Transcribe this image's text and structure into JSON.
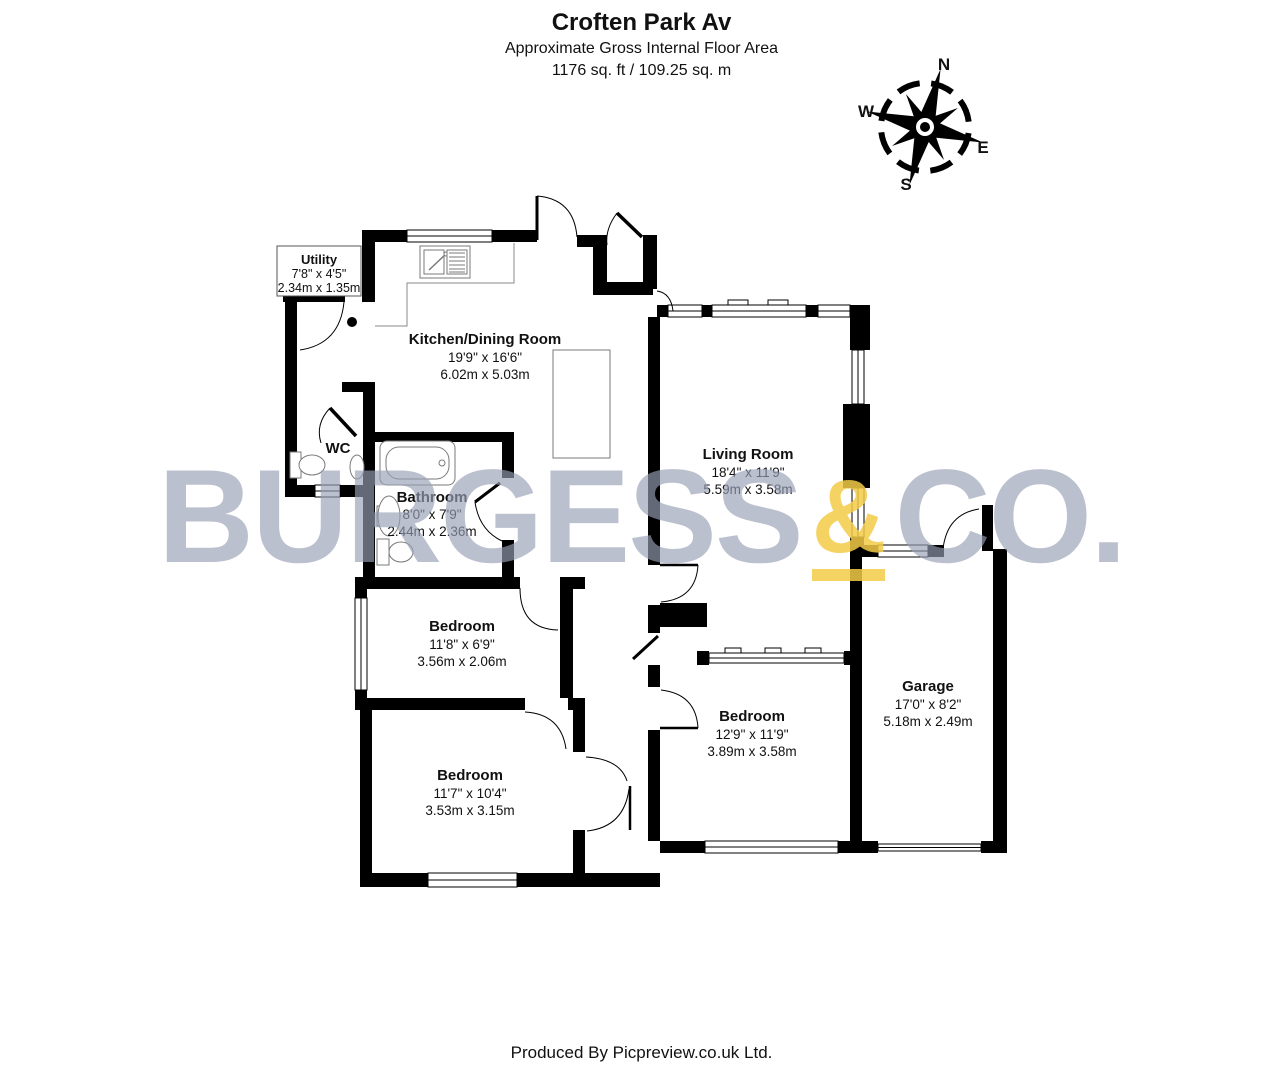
{
  "header": {
    "title": "Croften Park Av",
    "subtitle": "Approximate Gross Internal Floor Area",
    "area": "1176 sq. ft / 109.25 sq. m"
  },
  "compass": {
    "north": "N",
    "east": "E",
    "south": "S",
    "west": "W"
  },
  "rooms": {
    "utility": {
      "name": "Utility",
      "imperial": "7'8\" x 4'5\"",
      "metric": "2.34m x 1.35m"
    },
    "kitchen": {
      "name": "Kitchen/Dining Room",
      "imperial": "19'9\" x 16'6\"",
      "metric": "6.02m x 5.03m"
    },
    "wc": {
      "name": "WC"
    },
    "bathroom": {
      "name": "Bathroom",
      "imperial": "8'0\" x 7'9\"",
      "metric": "2.44m x 2.36m"
    },
    "living": {
      "name": "Living Room",
      "imperial": "18'4\" x 11'9\"",
      "metric": "5.59m x 3.58m"
    },
    "bedroom_mid": {
      "name": "Bedroom",
      "imperial": "11'8\" x 6'9\"",
      "metric": "3.56m x 2.06m"
    },
    "bedroom_left": {
      "name": "Bedroom",
      "imperial": "11'7\" x 10'4\"",
      "metric": "3.53m x 3.15m"
    },
    "bedroom_right": {
      "name": "Bedroom",
      "imperial": "12'9\" x 11'9\"",
      "metric": "3.89m x 3.58m"
    },
    "garage": {
      "name": "Garage",
      "imperial": "17'0\" x 8'2\"",
      "metric": "5.18m x 2.49m"
    }
  },
  "watermark": {
    "part1": "BURGESS",
    "amp": "&",
    "part2": "CO."
  },
  "footer": {
    "text": "Produced By Picpreview.co.uk Ltd."
  },
  "colors": {
    "wall": "#000000",
    "watermark_gray": "#989fb5",
    "watermark_yellow": "#f2cb46"
  }
}
